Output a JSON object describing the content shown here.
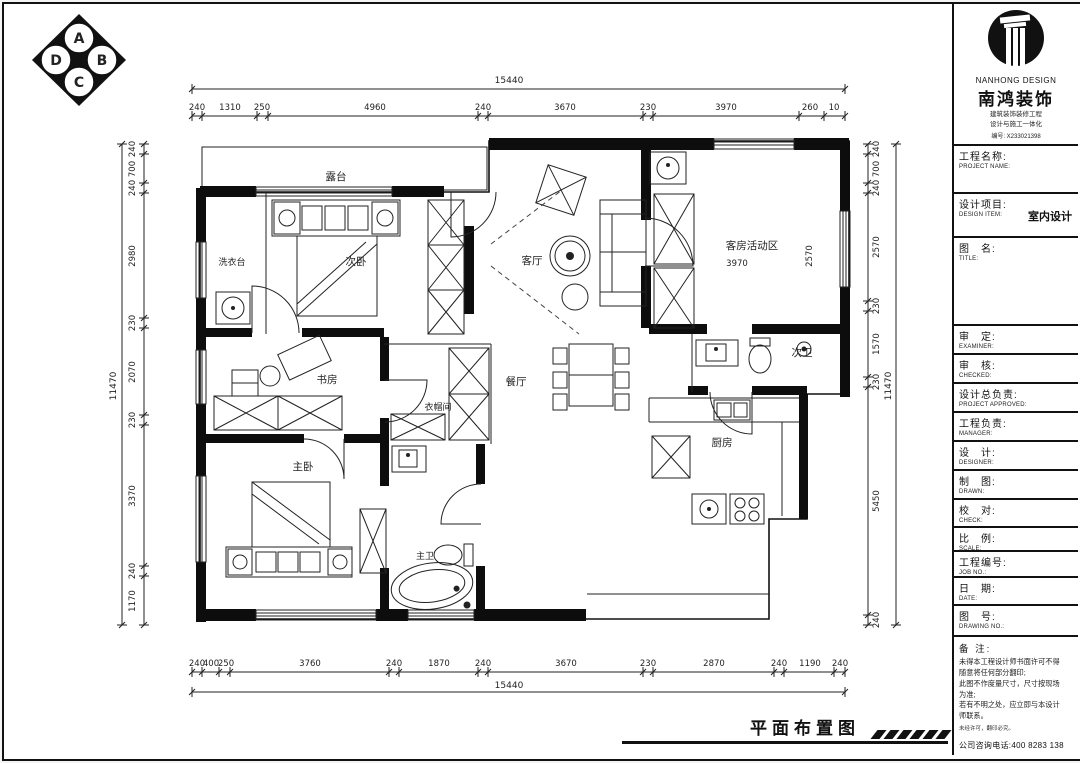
{
  "colors": {
    "ink": "#111111",
    "paper": "#ffffff"
  },
  "footer": {
    "title": "平面布置图"
  },
  "corner_logo": {
    "letters": [
      "A",
      "B",
      "C",
      "D"
    ]
  },
  "plan": {
    "rooms": {
      "terrace": "露台",
      "bedroom2": "次卧",
      "laundry": "洗衣台",
      "living": "客厅",
      "study": "书房",
      "cloakroom": "衣帽间",
      "dining": "餐厅",
      "guest_area": "客房活动区",
      "guest_area_w": "3970",
      "guest_area_h": "2570",
      "bath2": "次卫",
      "kitchen": "厨房",
      "master": "主卧",
      "master_bath": "主卫"
    },
    "dims": {
      "top": {
        "overall": "15440",
        "segments": [
          "240",
          "1310",
          "250",
          "4960",
          "240",
          "3670",
          "230",
          "3970",
          "260",
          "10"
        ]
      },
      "bottom": {
        "overall": "15440",
        "segments": [
          "240",
          "400",
          "250",
          "3760",
          "240",
          "1870",
          "240",
          "3670",
          "230",
          "2870",
          "240",
          "1190",
          "240"
        ]
      },
      "left": {
        "overall": "11470",
        "segments": [
          "240",
          "700",
          "240",
          "2980",
          "230",
          "2070",
          "230",
          "3370",
          "240",
          "1170"
        ]
      },
      "right": {
        "overall": "11470",
        "segments": [
          "240",
          "700",
          "240",
          "2570",
          "230",
          "1570",
          "230",
          "5450",
          "240"
        ]
      }
    }
  },
  "title_block": {
    "brand": {
      "en": "NANHONG DESIGN",
      "cn": "南鸿装饰",
      "cert1": "建筑装饰装修工程",
      "cert2": "设计与施工一体化",
      "license": "编号: X233021398"
    },
    "rows": [
      {
        "cn": "工程名称:",
        "en": "PROJECT NAME:"
      },
      {
        "cn": "设计项目:",
        "en": "DESIGN ITEM:",
        "value": "室内设计"
      },
      {
        "cn": "图　名:",
        "en": "TITLE:"
      },
      {
        "cn": "审　定:",
        "en": "EXAMINER:"
      },
      {
        "cn": "审　核:",
        "en": "CHECKED:"
      },
      {
        "cn": "设计总负责:",
        "en": "PROJECT APPROVED:"
      },
      {
        "cn": "工程负责:",
        "en": "MANAGER:"
      },
      {
        "cn": "设　计:",
        "en": "DESIGNER:"
      },
      {
        "cn": "制　图:",
        "en": "DRAWN:"
      },
      {
        "cn": "校　对:",
        "en": "CHECK:"
      },
      {
        "cn": "比　例:",
        "en": "SCALE:"
      },
      {
        "cn": "工程编号:",
        "en": "JOB NO.:"
      },
      {
        "cn": "日　期:",
        "en": "DATE:"
      },
      {
        "cn": "图　号:",
        "en": "DRAWING NO.:"
      }
    ],
    "remarks": {
      "label": "备 注:",
      "lines": [
        "未得本工程设计师书面许可不得",
        "随意将任何部分翻印;",
        "此图不作度量尺寸，尺寸按现场",
        "为准;",
        "若有不明之处，应立即与本设计",
        "师联系。"
      ],
      "tiny": "未经许可，翻印必究。",
      "phone": "公司咨询电话:400 8283 138"
    }
  }
}
